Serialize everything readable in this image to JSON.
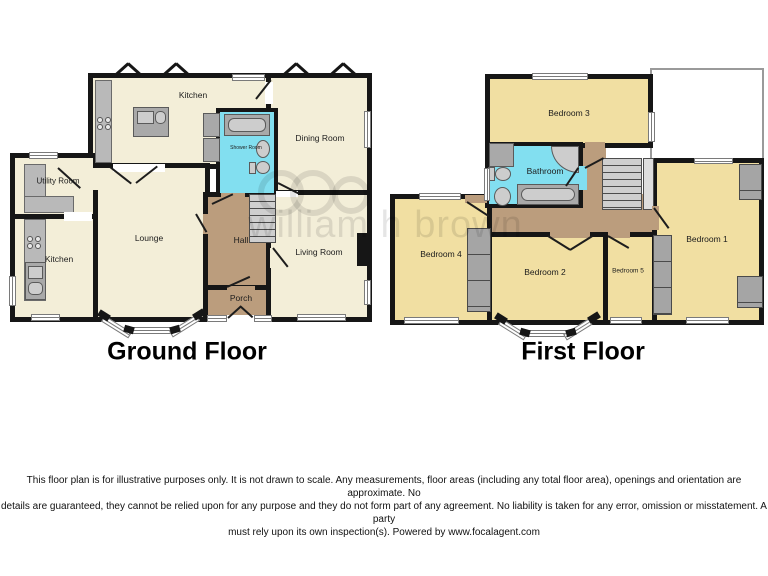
{
  "watermark": {
    "text": "william h brown"
  },
  "ground_floor": {
    "title": "Ground Floor",
    "rooms": {
      "kitchen_top": "Kitchen",
      "dining": "Dining Room",
      "shower": "Shower Room",
      "utility": "Utility Room",
      "kitchen_left": "Kitchen",
      "lounge": "Lounge",
      "hall": "Hall",
      "porch": "Porch",
      "living": "Living Room"
    }
  },
  "first_floor": {
    "title": "First Floor",
    "rooms": {
      "bedroom1": "Bedroom 1",
      "bedroom2": "Bedroom 2",
      "bedroom3": "Bedroom 3",
      "bedroom4": "Bedroom 4",
      "bedroom5": "Bedroom 5",
      "bathroom": "Bathroom"
    }
  },
  "disclaimer": {
    "lines": [
      "This floor plan is for illustrative purposes only. It is not drawn to scale. Any measurements, floor areas (including any total floor area), openings and orientation are approximate. No",
      "details are guaranteed, they cannot be relied upon for any purpose and they do not form part of any agreement. No liability is taken for any error, omission or misstatement. A party",
      "must rely upon its own inspection(s). Powered by www.focalagent.com"
    ]
  },
  "colors": {
    "wall": "#161616",
    "ground_room": "#f3eed8",
    "bedroom": "#f1dfa2",
    "wet_room": "#82dff0",
    "hall": "#bb9d7d",
    "fixture": "#a9a9a9"
  }
}
